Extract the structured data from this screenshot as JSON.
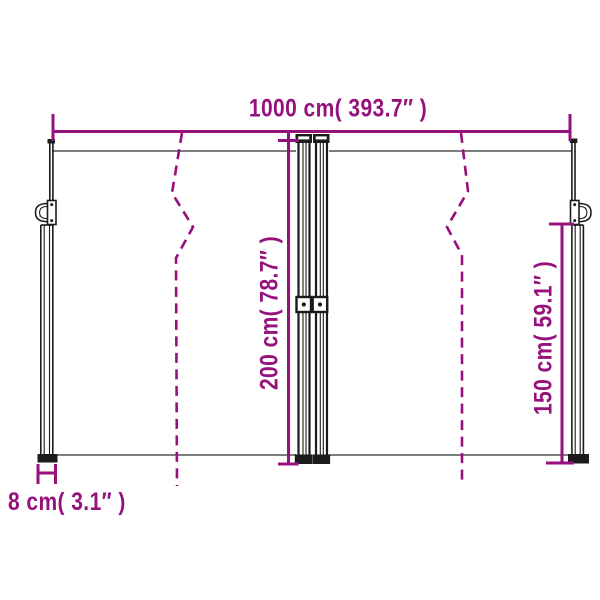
{
  "diagram": {
    "labels": {
      "total_width": "1000 cm( 393.7″ )",
      "height": "200 cm( 78.7″ )",
      "right_height": "150 cm( 59.1″ )",
      "post_depth": "8 cm( 3.1″ )"
    },
    "colors": {
      "accent": "#96117c",
      "structure": "#1b1b1b",
      "fabric_line": "#7d7d7d",
      "background": "#ffffff"
    }
  }
}
